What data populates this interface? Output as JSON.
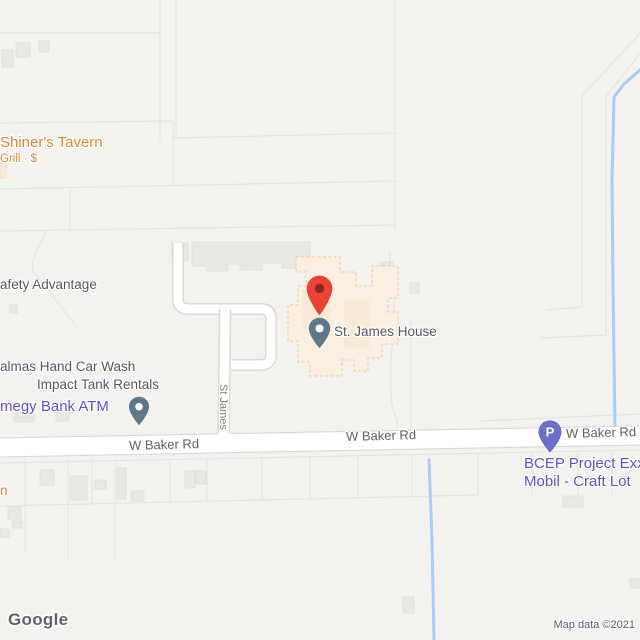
{
  "map": {
    "watermark": "Google",
    "attribution": "Map data ©2021",
    "pois": {
      "shiners_tavern": {
        "name": "Shiner's Tavern",
        "category": "Grill · $"
      },
      "safety_advantage": {
        "name": "afety Advantage"
      },
      "palmas_hand_car_wash": {
        "name": "almas Hand Car Wash"
      },
      "impact_tank_rentals": {
        "name": "Impact Tank Rentals"
      },
      "amegy_bank_atm": {
        "name": "megy Bank ATM"
      },
      "st_james_house": {
        "name": "St. James House"
      },
      "bcep_project": {
        "line1": "BCEP Project Exxo",
        "line2": "Mobil - Craft Lot"
      },
      "cutoff_poi": {
        "name": "n"
      }
    },
    "streets": {
      "st_james": "St James",
      "w_baker_left": "W Baker Rd",
      "w_baker_center": "W Baker Rd",
      "w_baker_right": "W Baker Rd"
    },
    "pins": {
      "parking_letter": "P"
    },
    "colors": {
      "land": "#F3F2EF",
      "road_fill": "#FFFFFF",
      "road_casing": "#DBDAD6",
      "parcel_line": "#E7E6E2",
      "building_fill": "#E9E8E4",
      "building_stroke": "#DDDCD7",
      "poi_building_fill": "#FBEFE1",
      "poi_building_stroke": "#EFC8A0",
      "water": "#A9CDF7",
      "label_dark": "#54585D",
      "label_street": "#7E7E7E",
      "label_road": "#5F6368",
      "label_orange": "#DC8435",
      "label_purple": "#5B51C8",
      "pin_red": "#EA4335",
      "pin_red_dot": "#8E2A22",
      "pin_slate": "#5F7887",
      "pin_purple": "#6B70C8"
    }
  }
}
